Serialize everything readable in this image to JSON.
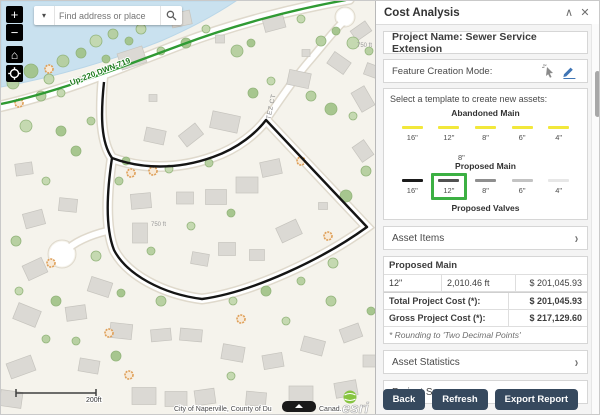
{
  "panel": {
    "title": "Cost Analysis",
    "collapse_icon": "collapse-up",
    "close_icon": "close",
    "project_name": "Project Name: Sewer Service Extension",
    "feature_creation_label": "Feature Creation Mode:",
    "template_prompt": "Select a template to create new assets:",
    "templates": {
      "abandoned_main": {
        "name": "Abandoned Main",
        "swatch_color": "#f2e83b",
        "sizes": [
          "16\"",
          "12\"",
          "8\"",
          "6\"",
          "4\""
        ],
        "extra_size": "8\""
      },
      "proposed_main": {
        "name": "Proposed Main",
        "colors": [
          "#1b1b1b",
          "#515151",
          "#8f8f8f",
          "#c3c3c3",
          "#e7e7e7"
        ],
        "sizes": [
          "16\"",
          "12\"",
          "8\"",
          "6\"",
          "4\""
        ],
        "selected_size": "12\"",
        "selected_outline": "#3cb043"
      },
      "proposed_valves": {
        "name": "Proposed Valves"
      }
    },
    "sections": {
      "asset_items": "Asset Items",
      "asset_statistics": "Asset Statistics",
      "project_summary": "Project Summary"
    },
    "cost_table": {
      "group_header": "Proposed Main",
      "row": [
        "12\"",
        "2,010.46 ft",
        "$ 201,045.93"
      ],
      "total_label": "Total Project Cost (*):",
      "total_value": "$ 201,045.93",
      "gross_label": "Gross Project Cost (*):",
      "gross_value": "$ 217,129.60",
      "footnote": "* Rounding to 'Two Decimal Points'"
    },
    "buttons": {
      "back": "Back",
      "refresh": "Refresh",
      "export": "Export Report"
    },
    "accent_blue": "#3f75b5",
    "button_color": "#36495e"
  },
  "map": {
    "search_placeholder": "Find address or place",
    "zoom_in": "+",
    "zoom_out": "−",
    "home_glyph": "⌂",
    "green_line_label": "Up-220 DWN-719",
    "street_label": "TEZ CT",
    "parcel_label": "750 ft",
    "scale_label": "200ft",
    "attribution_left": "City of Naperville, County of Du",
    "attribution_right": "Canad...",
    "esri_logo": "esri",
    "colors": {
      "background": "#f5f3ec",
      "water": "#c9e1ef",
      "road_fill": "#ffffff",
      "road_casing": "#dfd9cc",
      "building_fill": "#dbd9d4",
      "building_stroke": "#c6c4be",
      "tree_fills": [
        "#b5cf9f",
        "#a3c48b",
        "#c3d8ae"
      ],
      "tree_stroke": "#8fb277",
      "orange_tree_fill": "#f7ead8",
      "orange_tree_stroke": "#de9e56",
      "utility_green": "#2f9a33",
      "trace_black": "#151515"
    },
    "decor": {
      "buildings": [
        [
          131,
          57,
          26,
          17,
          -18
        ],
        [
          180,
          18,
          20,
          14,
          -12
        ],
        [
          219,
          38,
          9,
          8,
          0
        ],
        [
          152,
          97,
          8,
          7,
          0
        ],
        [
          154,
          135,
          20,
          14,
          12
        ],
        [
          190,
          134,
          21,
          14,
          -38
        ],
        [
          224,
          121,
          28,
          17,
          12
        ],
        [
          273,
          22,
          21,
          14,
          -15
        ],
        [
          305,
          52,
          8,
          7,
          0
        ],
        [
          298,
          78,
          22,
          15,
          12
        ],
        [
          338,
          62,
          20,
          14,
          35
        ],
        [
          362,
          98,
          22,
          15,
          60
        ],
        [
          362,
          150,
          18,
          14,
          55
        ],
        [
          140,
          200,
          20,
          15,
          -5
        ],
        [
          139,
          232,
          15,
          20,
          0
        ],
        [
          184,
          197,
          17,
          12,
          0
        ],
        [
          215,
          196,
          21,
          15,
          0
        ],
        [
          246,
          184,
          22,
          16,
          0
        ],
        [
          270,
          167,
          20,
          15,
          -12
        ],
        [
          226,
          248,
          17,
          13,
          0
        ],
        [
          288,
          230,
          22,
          16,
          -25
        ],
        [
          199,
          258,
          17,
          12,
          10
        ],
        [
          256,
          254,
          15,
          11,
          0
        ],
        [
          322,
          205,
          9,
          7,
          0
        ],
        [
          33,
          218,
          20,
          15,
          -15
        ],
        [
          34,
          268,
          21,
          16,
          -25
        ],
        [
          67,
          204,
          18,
          13,
          6
        ],
        [
          99,
          286,
          22,
          15,
          18
        ],
        [
          23,
          168,
          17,
          12,
          -8
        ],
        [
          26,
          314,
          24,
          17,
          22
        ],
        [
          75,
          312,
          20,
          14,
          -8
        ],
        [
          120,
          330,
          22,
          15,
          6
        ],
        [
          20,
          366,
          26,
          16,
          -20
        ],
        [
          88,
          365,
          20,
          13,
          10
        ],
        [
          10,
          398,
          22,
          16,
          8
        ],
        [
          143,
          395,
          24,
          17,
          0
        ],
        [
          175,
          398,
          22,
          15,
          0
        ],
        [
          204,
          396,
          20,
          15,
          -8
        ],
        [
          160,
          334,
          20,
          12,
          -5
        ],
        [
          190,
          334,
          22,
          12,
          5
        ],
        [
          232,
          352,
          22,
          15,
          10
        ],
        [
          272,
          360,
          20,
          14,
          -10
        ],
        [
          312,
          345,
          22,
          15,
          15
        ],
        [
          350,
          332,
          20,
          14,
          -20
        ],
        [
          300,
          393,
          24,
          16,
          0
        ],
        [
          255,
          398,
          20,
          14,
          5
        ],
        [
          345,
          388,
          22,
          15,
          -10
        ],
        [
          370,
          360,
          16,
          12,
          0
        ],
        [
          360,
          30,
          18,
          12,
          -35
        ],
        [
          372,
          70,
          16,
          12,
          20
        ]
      ],
      "trees": [
        [
          12,
          82,
          6
        ],
        [
          30,
          70,
          7
        ],
        [
          48,
          78,
          5
        ],
        [
          62,
          60,
          6
        ],
        [
          80,
          52,
          5
        ],
        [
          95,
          40,
          6
        ],
        [
          112,
          33,
          5
        ],
        [
          128,
          40,
          4
        ],
        [
          60,
          92,
          4
        ],
        [
          40,
          95,
          5
        ],
        [
          105,
          58,
          4
        ],
        [
          140,
          28,
          5
        ],
        [
          160,
          50,
          4
        ],
        [
          185,
          42,
          5
        ],
        [
          205,
          28,
          4
        ],
        [
          236,
          50,
          6
        ],
        [
          250,
          42,
          4
        ],
        [
          300,
          18,
          4
        ],
        [
          320,
          40,
          5
        ],
        [
          335,
          30,
          4
        ],
        [
          352,
          42,
          6
        ],
        [
          368,
          50,
          4
        ],
        [
          252,
          92,
          5
        ],
        [
          270,
          80,
          4
        ],
        [
          310,
          95,
          5
        ],
        [
          330,
          108,
          6
        ],
        [
          352,
          115,
          4
        ],
        [
          365,
          170,
          5
        ],
        [
          345,
          195,
          6
        ],
        [
          332,
          262,
          5
        ],
        [
          300,
          280,
          4
        ],
        [
          265,
          290,
          5
        ],
        [
          232,
          300,
          4
        ],
        [
          160,
          300,
          5
        ],
        [
          120,
          292,
          4
        ],
        [
          95,
          255,
          5
        ],
        [
          118,
          180,
          4
        ],
        [
          125,
          160,
          4
        ],
        [
          168,
          168,
          4
        ],
        [
          208,
          162,
          4
        ],
        [
          230,
          212,
          4
        ],
        [
          190,
          225,
          4
        ],
        [
          150,
          250,
          4
        ],
        [
          60,
          130,
          5
        ],
        [
          25,
          125,
          6
        ],
        [
          90,
          120,
          4
        ],
        [
          75,
          150,
          5
        ],
        [
          45,
          180,
          4
        ],
        [
          15,
          240,
          5
        ],
        [
          55,
          300,
          5
        ],
        [
          18,
          290,
          4
        ],
        [
          75,
          340,
          4
        ],
        [
          115,
          355,
          5
        ],
        [
          230,
          375,
          4
        ],
        [
          330,
          300,
          5
        ],
        [
          370,
          310,
          4
        ],
        [
          285,
          320,
          4
        ],
        [
          45,
          338,
          4
        ]
      ],
      "orange_trees": [
        [
          48,
          68
        ],
        [
          18,
          102
        ],
        [
          152,
          170
        ],
        [
          130,
          172
        ],
        [
          300,
          160
        ],
        [
          327,
          235
        ],
        [
          50,
          262
        ],
        [
          108,
          332
        ],
        [
          128,
          374
        ],
        [
          240,
          318
        ]
      ]
    }
  }
}
